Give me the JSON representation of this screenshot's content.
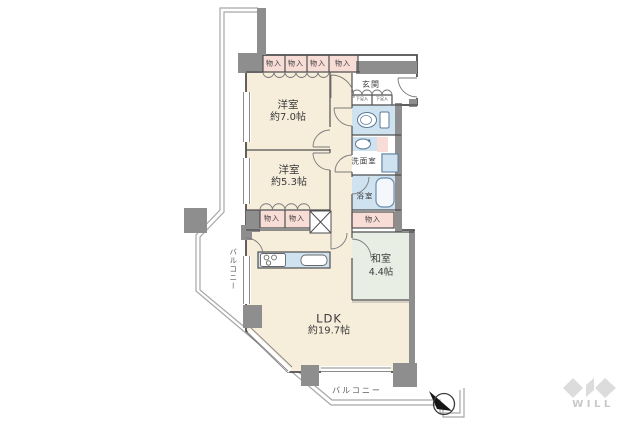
{
  "plan": {
    "rooms": [
      {
        "name": "洋室",
        "size": "約7.0帖"
      },
      {
        "name": "洋室",
        "size": "約5.3帖"
      },
      {
        "name": "和室",
        "size": "4.4帖"
      },
      {
        "name": "LDK",
        "size": "約19.7帖"
      }
    ],
    "labels": {
      "entrance": "玄関",
      "washroom": "洗面室",
      "bathroom": "浴室"
    },
    "closets": [
      "物入",
      "物入",
      "物入",
      "物入",
      "物入",
      "物入",
      "物入"
    ],
    "shoe_closets": [
      "下足入",
      "下足入"
    ],
    "balcony_left": "バルコニー",
    "balcony_bottom": "バルコニー",
    "logo": "WILL",
    "colors": {
      "room_cream": "#f6eddb",
      "closet_pink": "#f8dcd6",
      "water_blue": "#cfe2f0",
      "tatami_green": "#e8eee4",
      "wall_gray": "#8e8e8e"
    }
  }
}
